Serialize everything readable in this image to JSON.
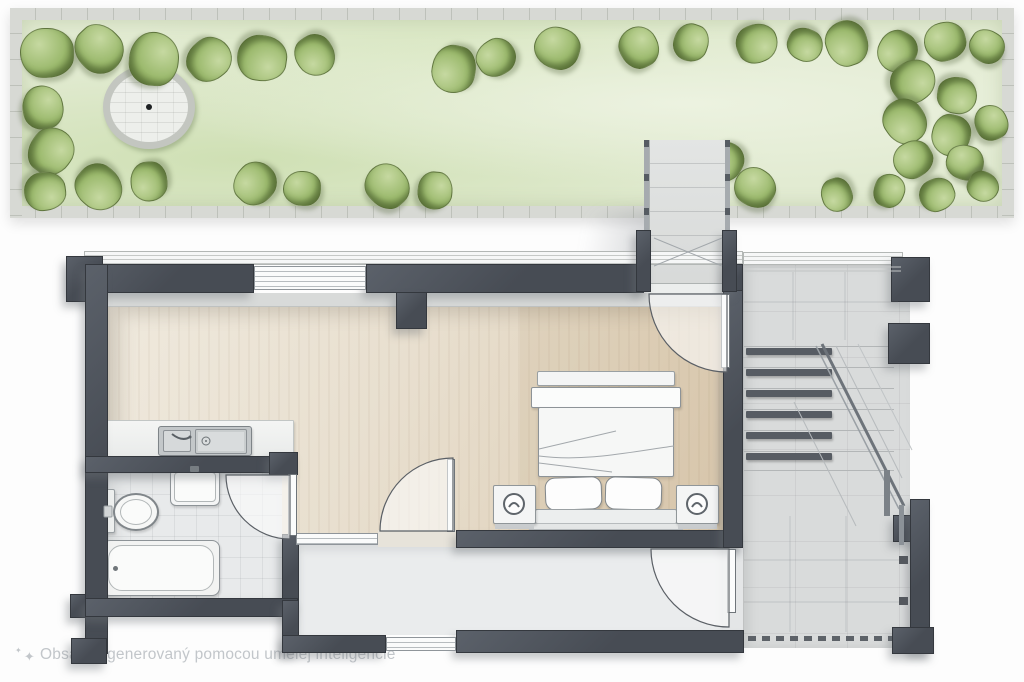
{
  "notice": {
    "icon_glyph_small": "✦",
    "icon_glyph": "✦",
    "text": "Obsah vygenerovaný pomocou umelej inteligencie"
  },
  "colors": {
    "wall": "#474c54",
    "wallDark": "#34383e",
    "wallLight": "#5b616a",
    "sill": "#f6f7f7",
    "wood": "#e8dfcf",
    "woodLight": "#efe9dd",
    "woodDark": "#ddcdb4",
    "ledge": "#d8dad9",
    "tile": "#e8eaeb",
    "hall": "#eaeced",
    "concrete": "#d9dbdb",
    "grass": "#e2ebd2",
    "grassLight": "#ecf2e0",
    "grassDark": "#cfe0b4",
    "bush": "#9cba6e",
    "bushLight": "#c6d9a1",
    "bushDark": "#6f8a42",
    "pave": "#d7d9d4",
    "paveTick": "#b7bbb3",
    "fixture": "#f4f5f5",
    "fixtureLine": "#8d9397",
    "noteText": "#c2c6ca",
    "shadow": "rgba(110,115,122,0.38)"
  },
  "garden": {
    "patio": {
      "cx": 151,
      "cy": 107,
      "rx": 46,
      "ry": 42
    },
    "bushes": [
      [
        48,
        52,
        26
      ],
      [
        100,
        48,
        24
      ],
      [
        155,
        58,
        26
      ],
      [
        210,
        58,
        22
      ],
      [
        263,
        57,
        24
      ],
      [
        316,
        54,
        20
      ],
      [
        455,
        68,
        23
      ],
      [
        497,
        56,
        19
      ],
      [
        558,
        47,
        22
      ],
      [
        640,
        46,
        20
      ],
      [
        692,
        42,
        18
      ],
      [
        758,
        42,
        20
      ],
      [
        806,
        44,
        17
      ],
      [
        848,
        42,
        22
      ],
      [
        898,
        50,
        20
      ],
      [
        946,
        40,
        20
      ],
      [
        988,
        46,
        17
      ],
      [
        44,
        106,
        21
      ],
      [
        52,
        150,
        23
      ],
      [
        46,
        190,
        20
      ],
      [
        100,
        186,
        23
      ],
      [
        150,
        180,
        19
      ],
      [
        256,
        182,
        21
      ],
      [
        303,
        188,
        18
      ],
      [
        388,
        185,
        22
      ],
      [
        436,
        190,
        18
      ],
      [
        914,
        80,
        22
      ],
      [
        958,
        94,
        19
      ],
      [
        906,
        120,
        22
      ],
      [
        952,
        134,
        20
      ],
      [
        914,
        158,
        19
      ],
      [
        966,
        162,
        18
      ],
      [
        992,
        122,
        17
      ],
      [
        890,
        190,
        16
      ],
      [
        938,
        194,
        17
      ],
      [
        984,
        186,
        15
      ],
      [
        838,
        194,
        16
      ],
      [
        726,
        160,
        19
      ],
      [
        700,
        188,
        19
      ],
      [
        756,
        186,
        20
      ]
    ]
  },
  "stairs": {
    "tread_rows": [
      346,
      367,
      388,
      409,
      430,
      451
    ],
    "last_line": 470,
    "line_x1": 744,
    "line_x2": 894,
    "tread_bar": {
      "x": 746,
      "w": 86,
      "h": 7
    },
    "dashes": {
      "y": 636,
      "x1": 748,
      "x2": 888,
      "step": 14,
      "w": 8,
      "h": 5
    }
  }
}
